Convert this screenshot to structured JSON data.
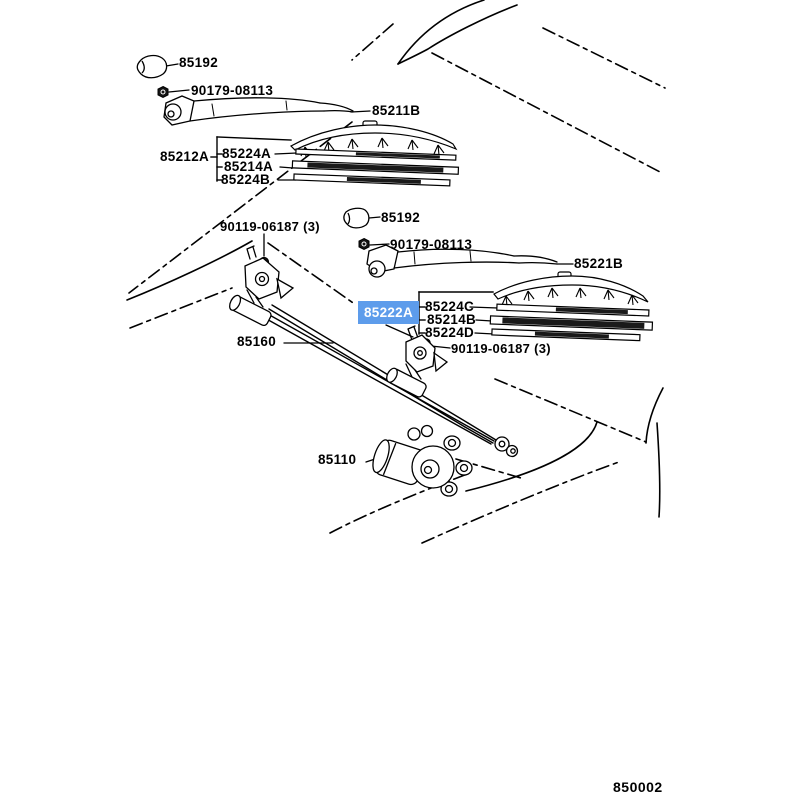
{
  "diagram": {
    "kind": "vehicle-parts-diagram (windshield wiper system)",
    "figure_code": "850002",
    "highlight": {
      "part": "85222A",
      "bg": "#5d9ceb",
      "text_color": "#ffffff"
    },
    "labels": {
      "cap_top": "85192",
      "nut_top": "90179-08113",
      "arm_top": "85211B",
      "blade_assy_top": "85212A",
      "blade_top_1": "85224A",
      "blade_top_2": "85214A",
      "blade_top_3": "85224B",
      "bolt_left": "90119-06187 (3)",
      "cap_mid": "85192",
      "nut_mid": "90179-08113",
      "arm_right": "85221B",
      "link_assy": "85222A",
      "blade_right_1": "85224C",
      "blade_right_2": "85214B",
      "blade_right_3": "85224D",
      "linkage": "85160",
      "bolt_right": "90119-06187 (3)",
      "motor": "85110"
    }
  }
}
